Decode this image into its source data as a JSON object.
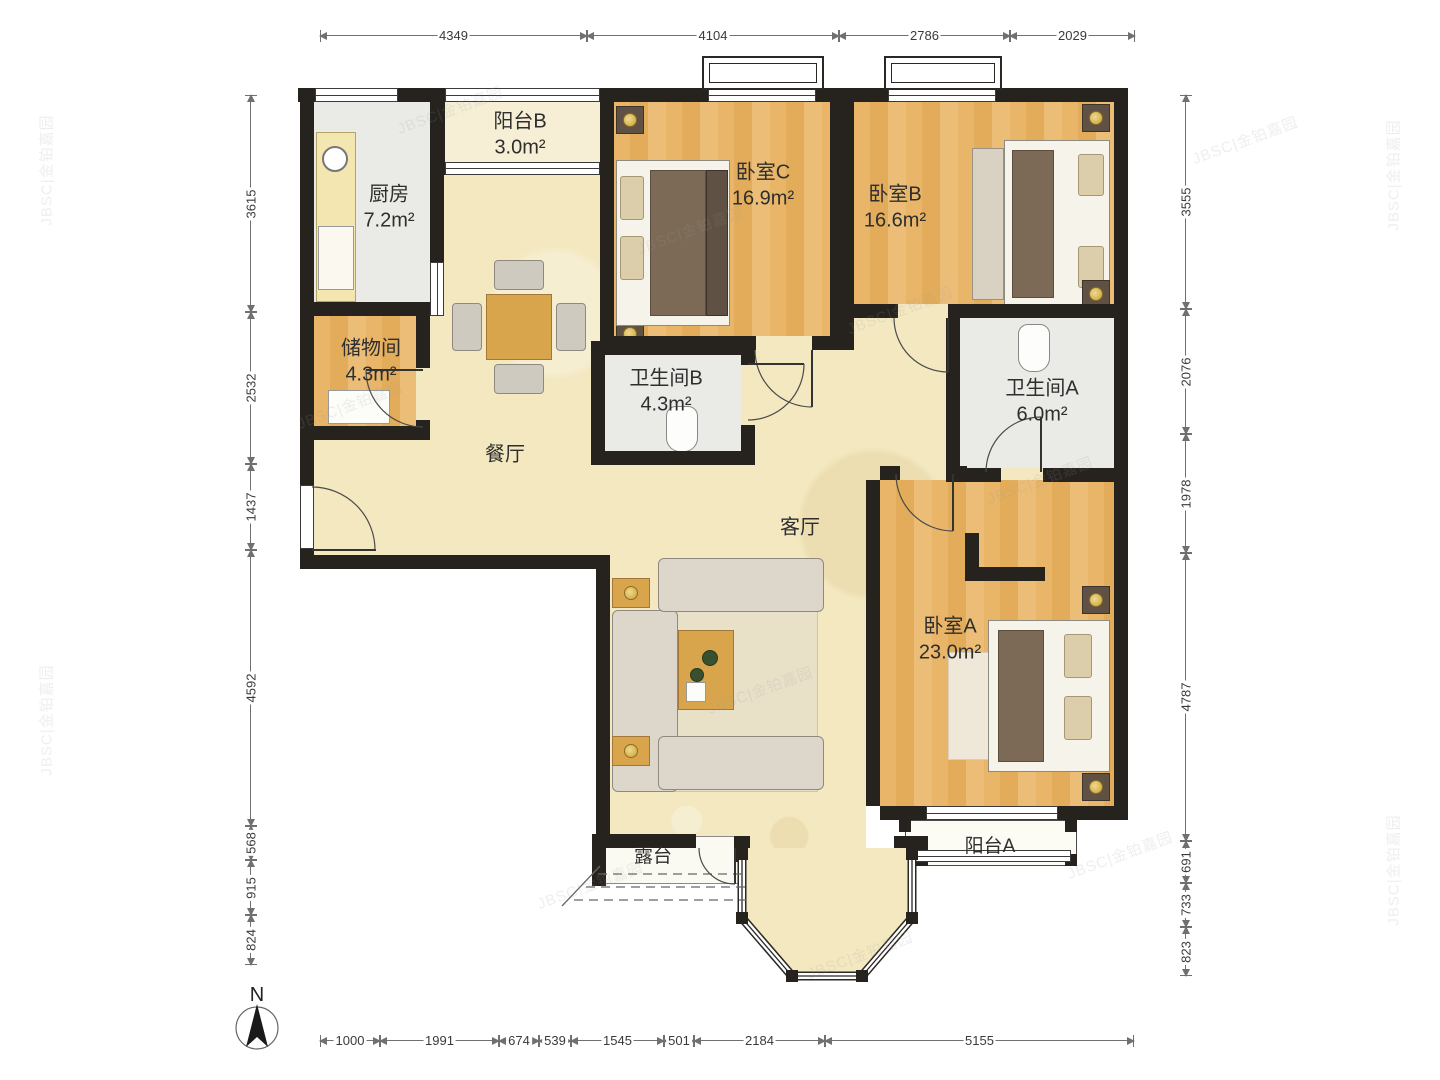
{
  "compass": {
    "label": "N"
  },
  "watermark": {
    "text": "JBSC|金铂嘉园"
  },
  "rooms": {
    "kitchen": {
      "label": "厨房",
      "area": "7.2m²"
    },
    "balcony_b": {
      "label": "阳台B",
      "area": "3.0m²"
    },
    "bedroom_c": {
      "label": "卧室C",
      "area": "16.9m²"
    },
    "bedroom_b": {
      "label": "卧室B",
      "area": "16.6m²"
    },
    "storage": {
      "label": "储物间",
      "area": "4.3m²"
    },
    "bathroom_b": {
      "label": "卫生间B",
      "area": "4.3m²"
    },
    "bathroom_a": {
      "label": "卫生间A",
      "area": "6.0m²"
    },
    "dining": {
      "label": "餐厅"
    },
    "living": {
      "label": "客厅"
    },
    "bedroom_a": {
      "label": "卧室A",
      "area": "23.0m²"
    },
    "balcony_a": {
      "label": "阳台A"
    },
    "terrace": {
      "label": "露台"
    }
  },
  "dimensions": {
    "top": [
      "4349",
      "4104",
      "2786",
      "2029"
    ],
    "left": [
      "3615",
      "2532",
      "1437",
      "4592",
      "568",
      "915",
      "824"
    ],
    "right": [
      "3555",
      "2076",
      "1978",
      "4787",
      "691",
      "733",
      "823"
    ],
    "bottom": [
      "1000",
      "1991",
      "674",
      "539",
      "1545",
      "501",
      "2184",
      "5155"
    ]
  },
  "colors": {
    "wall": "#26221e",
    "wood_floor": "#e7b569",
    "living_floor": "#f3e8c0",
    "tile_floor": "#eaeae6",
    "furniture_wood": "#d9a54c"
  }
}
